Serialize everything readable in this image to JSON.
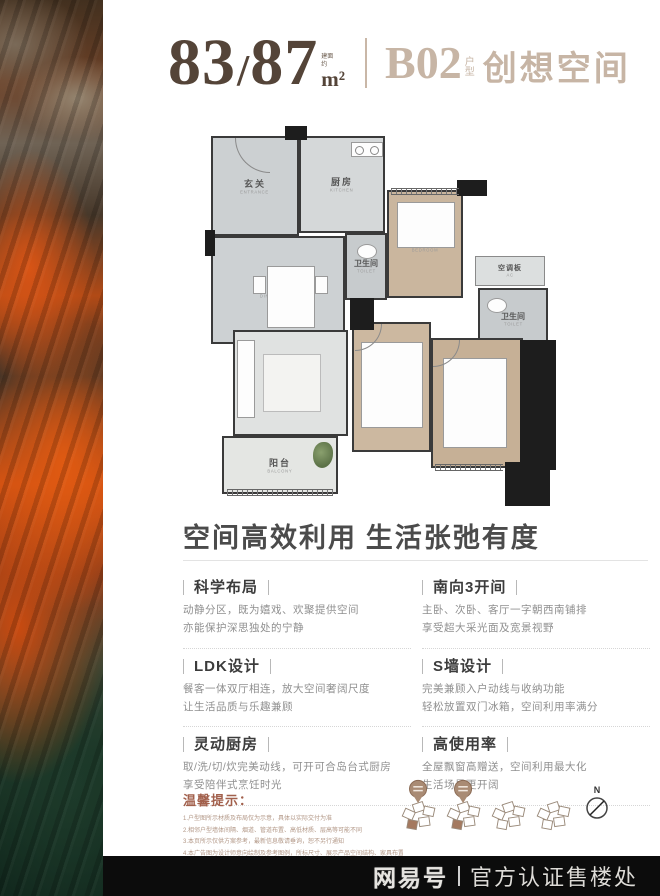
{
  "header": {
    "area_main": "83",
    "area_slash": "/",
    "area_alt": "87",
    "area_note_line1": "建面",
    "area_note_line2": "约",
    "area_unit": "m²",
    "unit_code": "B02",
    "unit_suffix_1": "户",
    "unit_suffix_2": "型",
    "unit_name": "创想空间"
  },
  "floorplan": {
    "rooms": [
      {
        "name_cn": "玄关",
        "name_en": "ENTRANCE"
      },
      {
        "name_cn": "厨房",
        "name_en": "KITCHEN"
      },
      {
        "name_cn": "餐厅",
        "name_en": "DINING ROOM"
      },
      {
        "name_cn": "卫生间",
        "name_en": "TOILET"
      },
      {
        "name_cn": "卧室",
        "name_en": "BEDROOM"
      },
      {
        "name_cn": "空调板",
        "name_en": "AC"
      },
      {
        "name_cn": "卫生间",
        "name_en": "TOILET"
      },
      {
        "name_cn": "客厅",
        "name_en": "LIVING ROOM"
      },
      {
        "name_cn": "卧室",
        "name_en": "BEDROOM"
      },
      {
        "name_cn": "主卧室",
        "name_en": "MASTER BEDROOM"
      },
      {
        "name_cn": "阳台",
        "name_en": "BALCONY"
      }
    ]
  },
  "section": {
    "heading": "空间高效利用 生活张弛有度"
  },
  "features": [
    {
      "title": "科学布局",
      "line1": "动静分区，既为嬉戏、欢聚提供空间",
      "line2": "亦能保护深思独处的宁静"
    },
    {
      "title": "南向3开间",
      "line1": "主卧、次卧、客厅一字朝西南铺排",
      "line2": "享受超大采光面及宽景视野"
    },
    {
      "title": "LDK设计",
      "line1": "餐客一体双厅相连，放大空间奢阔尺度",
      "line2": "让生活品质与乐趣兼顾"
    },
    {
      "title": "S墙设计",
      "line1": "完美兼顾入户动线与收纳功能",
      "line2": "轻松放置双门冰箱，空间利用率满分"
    },
    {
      "title": "灵动厨房",
      "line1": "取/洗/切/炊完美动线，可开可合岛台式厨房",
      "line2": "享受陪伴式烹饪时光"
    },
    {
      "title": "高使用率",
      "line1": "全屋飘窗高赠送，空间利用最大化",
      "line2": "生活场景更开阔"
    }
  ],
  "tips": {
    "title": "温馨提示：",
    "lines": [
      "1.户型图所示材质及布局仅为示意，具体以实际交付为准",
      "2.相邻户型墙体间隔、烟道、管道布置、高低材质、层高等可能不同",
      "3.本页所示仅供方案参考，最新信息敬请垂询，恕不另行通知",
      "4.本广告图为设计师意向绘制及参考图例，所标尺寸、展示产品空间结构、家具布置及装饰摆设等仅供参考，不作为交付标准与合同依据，不构成要约"
    ]
  },
  "compass": {
    "label": "N"
  },
  "footer": {
    "brand": "网易号",
    "text": "官方认证售楼处"
  },
  "colors": {
    "accent_brown": "#544438",
    "accent_tan": "#c7b5a5",
    "tips_red": "#a2604c",
    "footer_bg": "#0c0c0c"
  }
}
